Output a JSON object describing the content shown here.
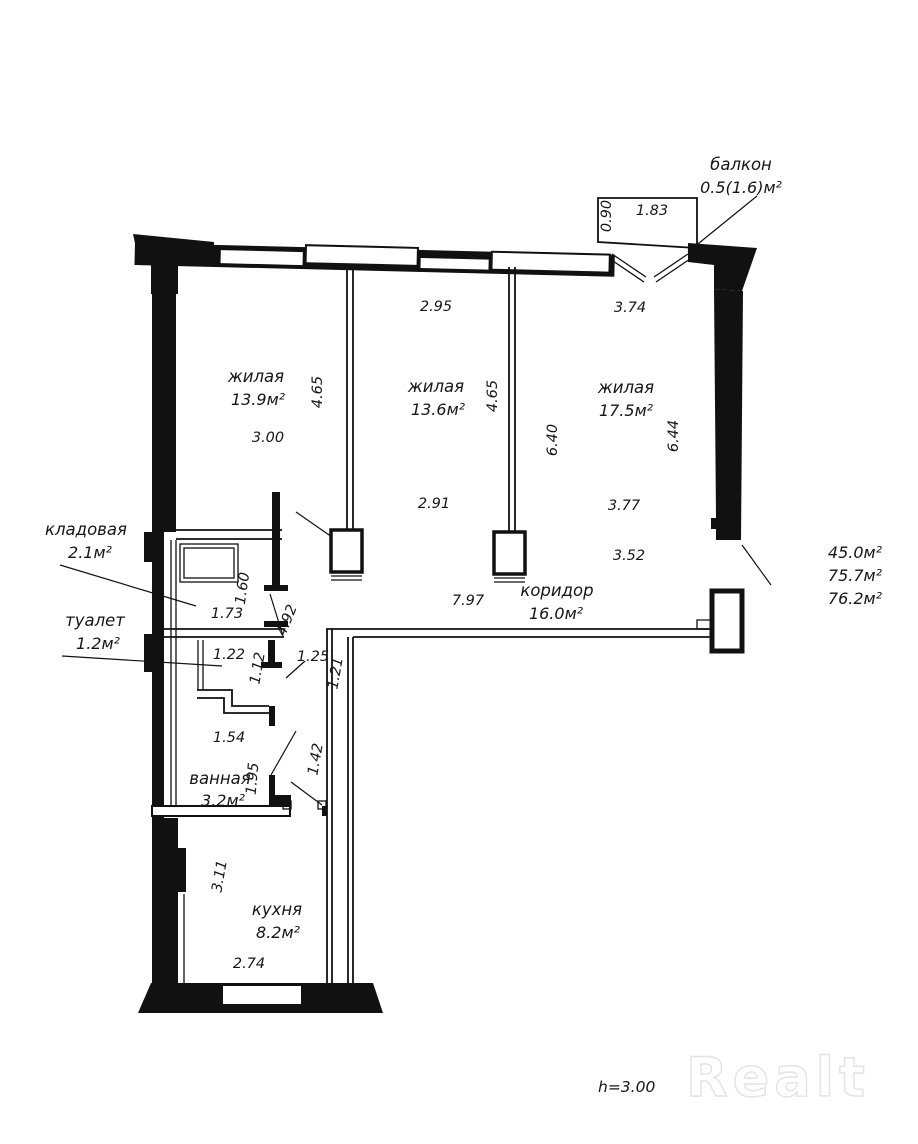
{
  "plan": {
    "balcony": {
      "name": "балкон",
      "area": "0.5(1.6)м²",
      "dims": {
        "depth": "0.90",
        "width": "1.83"
      }
    },
    "living1": {
      "name": "жилая",
      "area": "13.9м²",
      "dims": {
        "bottom": "3.00",
        "side": "4.65"
      }
    },
    "living2": {
      "name": "жилая",
      "area": "13.6м²",
      "dims": {
        "top": "2.95",
        "side": "4.65",
        "bottom": "2.91",
        "mid": "6.40"
      }
    },
    "living3": {
      "name": "жилая",
      "area": "17.5м²",
      "dims": {
        "top": "3.74",
        "side": "6.44",
        "bottom": "3.77",
        "lower": "3.52"
      }
    },
    "storage": {
      "name": "кладовая",
      "area": "2.1м²",
      "dims": {
        "width": "1.73",
        "height": "1.60",
        "wall": "4.92"
      }
    },
    "toilet": {
      "name": "туалет",
      "area": "1.2м²",
      "dims": {
        "width": "1.22",
        "height": "1.12",
        "door": "1.25",
        "hall": "1.21"
      }
    },
    "bathroom": {
      "name": "ванная",
      "area": "3.2м²",
      "dims": {
        "width": "1.54",
        "height": "1.95",
        "hall": "1.42"
      }
    },
    "corridor": {
      "name": "коридор",
      "area": "16.0м²",
      "dims": {
        "length": "7.97"
      }
    },
    "kitchen": {
      "name": "кухня",
      "area": "8.2м²",
      "dims": {
        "width": "2.74",
        "height": "3.11"
      }
    },
    "totals": {
      "living": "45.0м²",
      "total": "75.7м²",
      "total_with_balcony": "76.2м²"
    },
    "ceiling_height": "h=3.00",
    "watermark": "Realt"
  }
}
